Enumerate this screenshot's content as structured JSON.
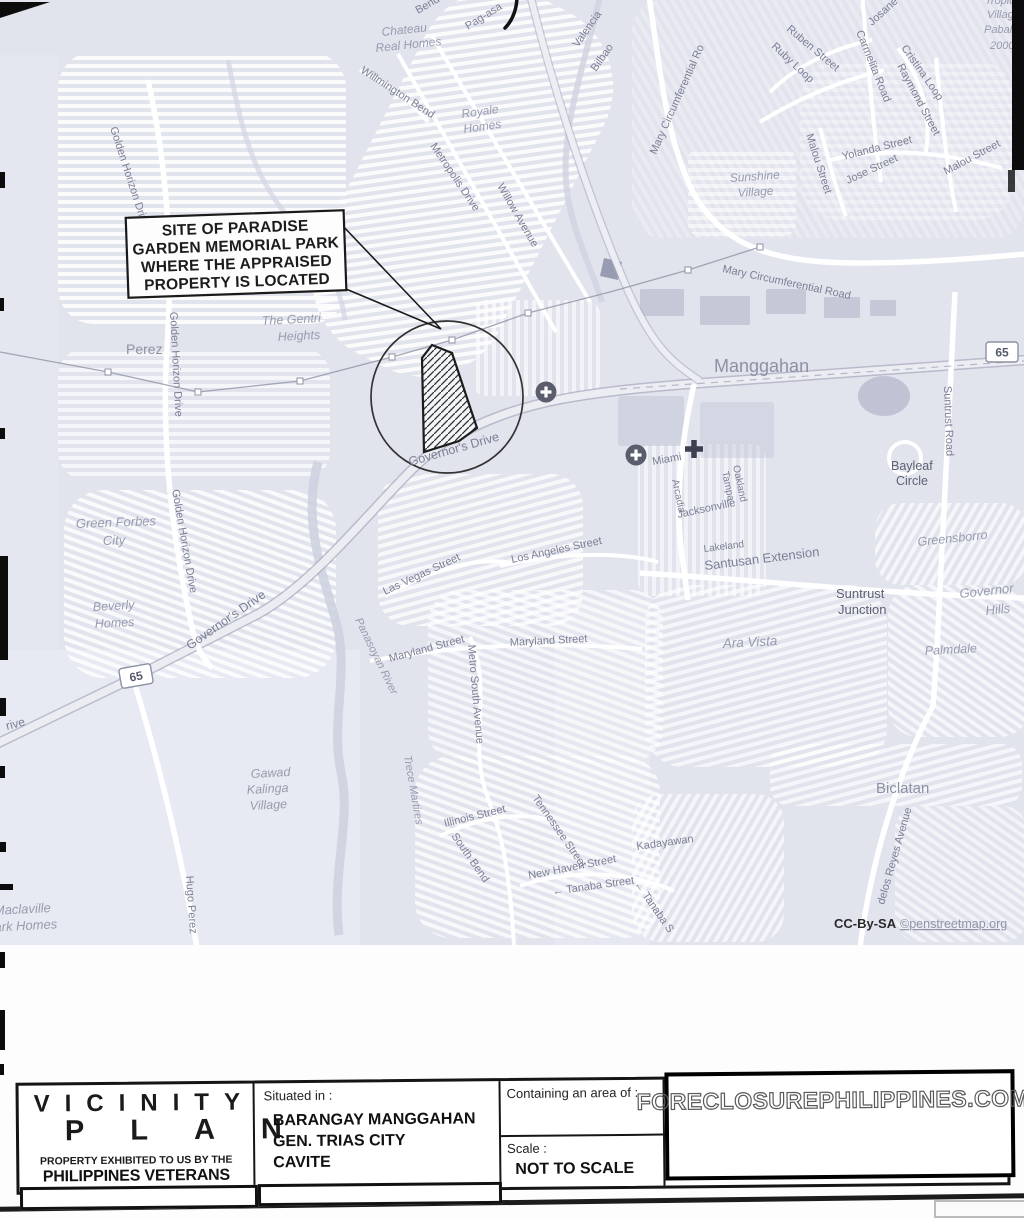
{
  "watermark": "FORECLOSUREPHILIPPINES.COM",
  "callout": {
    "lines": [
      "SITE OF PARADISE",
      "GARDEN MEMORIAL PARK",
      "WHERE THE APPRAISED",
      "PROPERTY IS LOCATED"
    ]
  },
  "title_block": {
    "title_line1": "VICINITY",
    "title_line2": "PLAN",
    "subtitle_small": "PROPERTY EXHIBITED TO US BY THE",
    "subtitle_bank": "PHILIPPINES VETERANS BANK",
    "situated_label": "Situated in :",
    "situated_lines": [
      "BARANGAY MANGGAHAN",
      "GEN. TRIAS CITY",
      "CAVITE"
    ],
    "area_label": "Containing an area of :",
    "scale_label": "Scale :",
    "scale_value": "NOT TO SCALE"
  },
  "map": {
    "colors": {
      "background": "#e1e3ed",
      "street_fill": "#ffffff",
      "label": "#7b7f94",
      "place_label": "#8d91a4"
    },
    "shields": [
      {
        "label": "65",
        "x": 136,
        "y": 676,
        "r": -10
      },
      {
        "label": "65",
        "x": 1002,
        "y": 352,
        "r": 0
      }
    ],
    "icons": [
      {
        "name": "health-circle-icon",
        "x": 546,
        "y": 392
      },
      {
        "name": "health-circle-icon",
        "x": 636,
        "y": 455
      },
      {
        "name": "hospital-cross-icon",
        "x": 694,
        "y": 449
      }
    ],
    "labels": [
      {
        "t": "Bend",
        "x": 418,
        "y": 14,
        "r": -30,
        "s": 11,
        "k": "street"
      },
      {
        "t": "Pag-asa",
        "x": 468,
        "y": 30,
        "r": -32,
        "s": 11,
        "k": "street"
      },
      {
        "t": "Chateau",
        "x": 382,
        "y": 36,
        "r": -6,
        "s": 12,
        "k": "village"
      },
      {
        "t": "Real Homes",
        "x": 376,
        "y": 52,
        "r": -6,
        "s": 12,
        "k": "village"
      },
      {
        "t": "Willmington Bend",
        "x": 360,
        "y": 72,
        "r": 33,
        "s": 11,
        "k": "street"
      },
      {
        "t": "Royale",
        "x": 462,
        "y": 118,
        "r": -8,
        "s": 12,
        "k": "village"
      },
      {
        "t": "Homes",
        "x": 464,
        "y": 133,
        "r": -8,
        "s": 12,
        "k": "village"
      },
      {
        "t": "Metropolis Drive",
        "x": 430,
        "y": 146,
        "r": 56,
        "s": 11,
        "k": "street"
      },
      {
        "t": "Willow Avenue",
        "x": 497,
        "y": 186,
        "r": 60,
        "s": 11,
        "k": "street"
      },
      {
        "t": "Valencia",
        "x": 578,
        "y": 48,
        "r": -55,
        "s": 11,
        "k": "street"
      },
      {
        "t": "Bilbao",
        "x": 596,
        "y": 72,
        "r": -55,
        "s": 11,
        "k": "street"
      },
      {
        "t": "Mary Circumferential Ro",
        "x": 656,
        "y": 155,
        "r": -66,
        "s": 11,
        "k": "street"
      },
      {
        "t": "Josane",
        "x": 872,
        "y": 26,
        "r": -42,
        "s": 11,
        "k": "street"
      },
      {
        "t": "Ruben Street",
        "x": 786,
        "y": 30,
        "r": 40,
        "s": 11,
        "k": "street"
      },
      {
        "t": "Ruby Loop",
        "x": 771,
        "y": 47,
        "r": 43,
        "s": 11,
        "k": "street"
      },
      {
        "t": "Carmelita Road",
        "x": 856,
        "y": 32,
        "r": 68,
        "s": 11,
        "k": "street"
      },
      {
        "t": "Cristina Loop",
        "x": 901,
        "y": 48,
        "r": 55,
        "s": 11,
        "k": "street"
      },
      {
        "t": "Raymond Street",
        "x": 897,
        "y": 66,
        "r": 62,
        "s": 11,
        "k": "street"
      },
      {
        "t": "Tropical",
        "x": 985,
        "y": 4,
        "r": 0,
        "s": 11,
        "k": "village"
      },
      {
        "t": "Village",
        "x": 987,
        "y": 18,
        "r": 0,
        "s": 11,
        "k": "village"
      },
      {
        "t": "Pabahay",
        "x": 984,
        "y": 33,
        "r": 0,
        "s": 11,
        "k": "village"
      },
      {
        "t": "2000",
        "x": 990,
        "y": 49,
        "r": 0,
        "s": 11,
        "k": "village"
      },
      {
        "t": "Sunshine",
        "x": 730,
        "y": 182,
        "r": -4,
        "s": 12,
        "k": "village"
      },
      {
        "t": "Village",
        "x": 738,
        "y": 197,
        "r": -4,
        "s": 12,
        "k": "village"
      },
      {
        "t": "Malou Street",
        "x": 806,
        "y": 135,
        "r": 72,
        "s": 11,
        "k": "street"
      },
      {
        "t": "Yolanda Street",
        "x": 843,
        "y": 160,
        "r": -14,
        "s": 11,
        "k": "street"
      },
      {
        "t": "Jose Street",
        "x": 848,
        "y": 184,
        "r": -25,
        "s": 11,
        "k": "street"
      },
      {
        "t": "Malou Street",
        "x": 946,
        "y": 175,
        "r": -28,
        "s": 11,
        "k": "street"
      },
      {
        "t": "Mary Circumferential Road",
        "x": 722,
        "y": 272,
        "r": 12,
        "s": 11,
        "k": "street"
      },
      {
        "t": "Manggahan",
        "x": 714,
        "y": 372,
        "r": 0,
        "s": 18,
        "k": "place"
      },
      {
        "t": "Suntrust Road",
        "x": 944,
        "y": 386,
        "r": 88,
        "s": 11,
        "k": "street"
      },
      {
        "t": "Bayleaf",
        "x": 891,
        "y": 470,
        "r": 0,
        "s": 12.5,
        "k": "dark"
      },
      {
        "t": "Circle",
        "x": 896,
        "y": 485,
        "r": 0,
        "s": 12.5,
        "k": "dark"
      },
      {
        "t": "Miami",
        "x": 653,
        "y": 465,
        "r": -10,
        "s": 11,
        "k": "street"
      },
      {
        "t": "Arcadia",
        "x": 672,
        "y": 480,
        "r": 78,
        "s": 10,
        "k": "street"
      },
      {
        "t": "Oakland",
        "x": 733,
        "y": 466,
        "r": 78,
        "s": 10,
        "k": "street"
      },
      {
        "t": "Tampa",
        "x": 722,
        "y": 472,
        "r": 78,
        "s": 10,
        "k": "street"
      },
      {
        "t": "Jacksonville",
        "x": 678,
        "y": 518,
        "r": -12,
        "s": 11,
        "k": "street"
      },
      {
        "t": "Lakeland",
        "x": 704,
        "y": 552,
        "r": -7,
        "s": 10,
        "k": "street"
      },
      {
        "t": "Santusan Extension",
        "x": 705,
        "y": 570,
        "r": -7,
        "s": 13,
        "k": "street"
      },
      {
        "t": "Suntrust",
        "x": 836,
        "y": 598,
        "r": 0,
        "s": 13,
        "k": "dark"
      },
      {
        "t": "Junction",
        "x": 838,
        "y": 614,
        "r": 0,
        "s": 13,
        "k": "dark"
      },
      {
        "t": "Greensborro",
        "x": 918,
        "y": 546,
        "r": -6,
        "s": 12.5,
        "k": "village"
      },
      {
        "t": "Governor",
        "x": 960,
        "y": 598,
        "r": -6,
        "s": 13,
        "k": "village"
      },
      {
        "t": "Hills",
        "x": 986,
        "y": 615,
        "r": -6,
        "s": 13,
        "k": "village"
      },
      {
        "t": "Ara Vista",
        "x": 723,
        "y": 648,
        "r": -3,
        "s": 13.5,
        "k": "village"
      },
      {
        "t": "Palmdale",
        "x": 925,
        "y": 655,
        "r": -3,
        "s": 12.5,
        "k": "village"
      },
      {
        "t": "The Gentri",
        "x": 262,
        "y": 325,
        "r": -3,
        "s": 12.5,
        "k": "village"
      },
      {
        "t": "Heights",
        "x": 278,
        "y": 341,
        "r": -3,
        "s": 12.5,
        "k": "village"
      },
      {
        "t": "Perez",
        "x": 126,
        "y": 354,
        "r": 0,
        "s": 14,
        "k": "place"
      },
      {
        "t": "Golden Horizon Drive",
        "x": 110,
        "y": 128,
        "r": 72,
        "s": 11,
        "k": "street"
      },
      {
        "t": "Golden Horizon Drive",
        "x": 170,
        "y": 312,
        "r": 87,
        "s": 11,
        "k": "street"
      },
      {
        "t": "Golden Horizon Drive",
        "x": 172,
        "y": 490,
        "r": 80,
        "s": 11,
        "k": "street"
      },
      {
        "t": "Green Forbes",
        "x": 76,
        "y": 528,
        "r": -2,
        "s": 13,
        "k": "village"
      },
      {
        "t": "City",
        "x": 103,
        "y": 545,
        "r": -2,
        "s": 13,
        "k": "village"
      },
      {
        "t": "Beverly",
        "x": 93,
        "y": 611,
        "r": -3,
        "s": 12.5,
        "k": "village"
      },
      {
        "t": "Homes",
        "x": 95,
        "y": 628,
        "r": -3,
        "s": 12.5,
        "k": "village"
      },
      {
        "t": "Governor's Drive",
        "x": 190,
        "y": 650,
        "r": -35,
        "s": 12.5,
        "k": "street"
      },
      {
        "t": "Governor's Drive",
        "x": 410,
        "y": 466,
        "r": -16,
        "s": 12.5,
        "k": "street"
      },
      {
        "t": "rive",
        "x": 7,
        "y": 730,
        "r": -14,
        "s": 12,
        "k": "street"
      },
      {
        "t": "Gawad",
        "x": 251,
        "y": 778,
        "r": -3,
        "s": 12.5,
        "k": "village"
      },
      {
        "t": "Kalinga",
        "x": 247,
        "y": 794,
        "r": -3,
        "s": 12.5,
        "k": "village"
      },
      {
        "t": "Village",
        "x": 250,
        "y": 810,
        "r": -3,
        "s": 12.5,
        "k": "village"
      },
      {
        "t": "Hugo Perez",
        "x": 186,
        "y": 876,
        "r": 86,
        "s": 11,
        "k": "street"
      },
      {
        "t": "Panasoyan River",
        "x": 355,
        "y": 620,
        "r": 64,
        "s": 11,
        "k": "village"
      },
      {
        "t": "Trece Martires",
        "x": 404,
        "y": 756,
        "r": 80,
        "s": 11,
        "k": "village"
      },
      {
        "t": "Las Vegas Street",
        "x": 385,
        "y": 595,
        "r": -25,
        "s": 11,
        "k": "street"
      },
      {
        "t": "Los Angeles Street",
        "x": 512,
        "y": 563,
        "r": -12,
        "s": 11,
        "k": "street"
      },
      {
        "t": "Maryland Street",
        "x": 390,
        "y": 662,
        "r": -15,
        "s": 11,
        "k": "street"
      },
      {
        "t": "Maryland Street",
        "x": 510,
        "y": 646,
        "r": -3,
        "s": 11,
        "k": "street"
      },
      {
        "t": "Metro South Avenue",
        "x": 468,
        "y": 645,
        "r": 85,
        "s": 11,
        "k": "street"
      },
      {
        "t": "Illinois Street",
        "x": 445,
        "y": 827,
        "r": -14,
        "s": 11,
        "k": "street"
      },
      {
        "t": "South Bend",
        "x": 451,
        "y": 836,
        "r": 55,
        "s": 11,
        "k": "street"
      },
      {
        "t": "Tennessee Street",
        "x": 532,
        "y": 798,
        "r": 55,
        "s": 11,
        "k": "street"
      },
      {
        "t": "New Haven Street",
        "x": 529,
        "y": 879,
        "r": -11,
        "s": 11,
        "k": "street"
      },
      {
        "t": "← Tanaba Street",
        "x": 553,
        "y": 895,
        "r": -8,
        "s": 11,
        "k": "street"
      },
      {
        "t": "← Tanaba S",
        "x": 634,
        "y": 884,
        "r": 55,
        "s": 11,
        "k": "street"
      },
      {
        "t": "Kadayawan",
        "x": 637,
        "y": 850,
        "r": -8,
        "s": 11,
        "k": "street"
      },
      {
        "t": "Maclaville",
        "x": -6,
        "y": 915,
        "r": -3,
        "s": 13,
        "k": "village"
      },
      {
        "t": "Park Homes",
        "x": -14,
        "y": 932,
        "r": -3,
        "s": 13,
        "k": "village"
      },
      {
        "t": "Biclatan",
        "x": 876,
        "y": 793,
        "r": 0,
        "s": 15,
        "k": "place"
      },
      {
        "t": "delos Reyes Avenue",
        "x": 884,
        "y": 905,
        "r": -74,
        "s": 11,
        "k": "street"
      },
      {
        "t": "CC-By-SA",
        "x": 834,
        "y": 928,
        "r": 0,
        "s": 13,
        "k": "attr"
      },
      {
        "t": "©penstreetmap.org",
        "x": 900,
        "y": 928,
        "r": 0,
        "s": 12.5,
        "k": "link"
      }
    ]
  }
}
